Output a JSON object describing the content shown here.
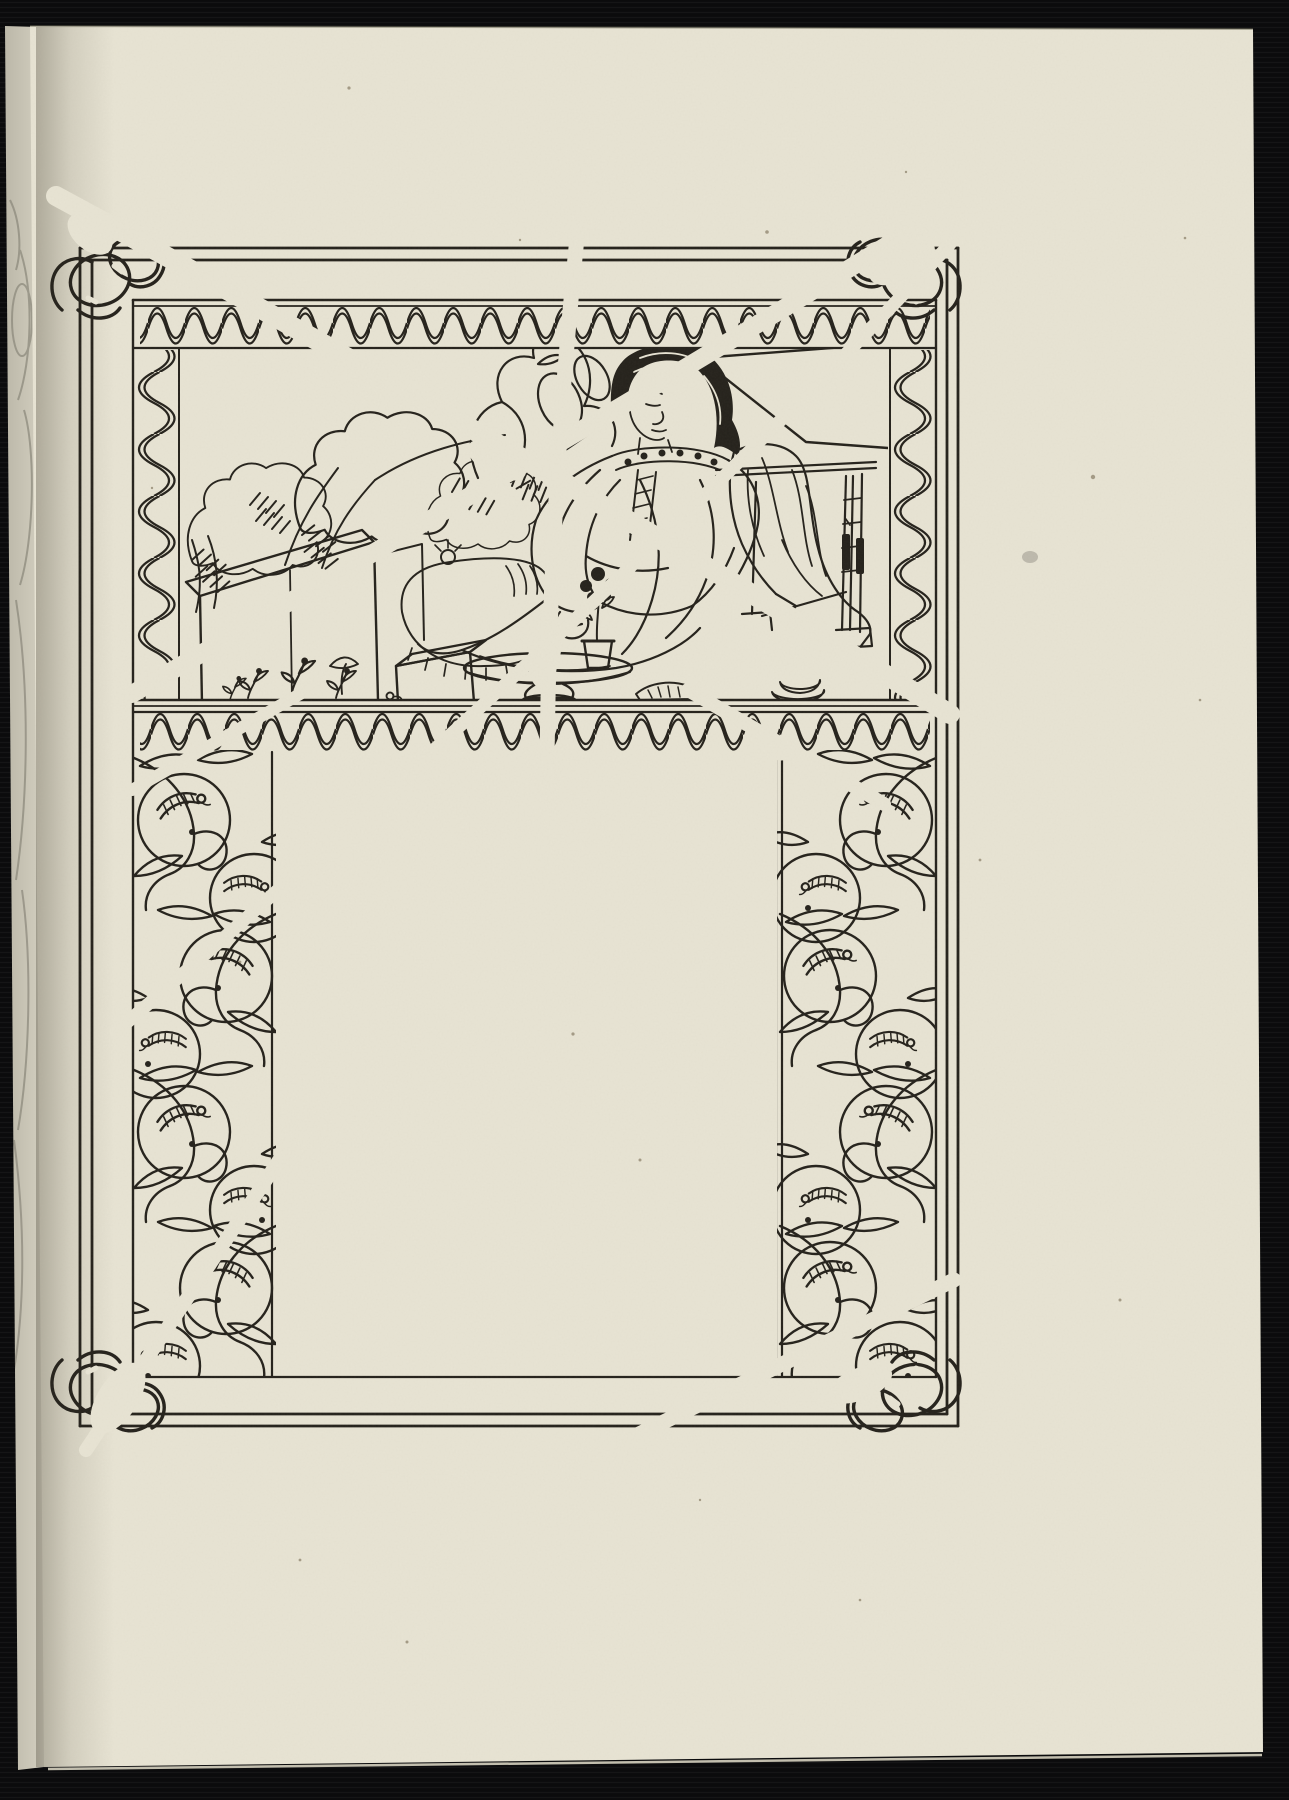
{
  "document": {
    "kind": "scanned book page",
    "description": "Scanned book page with an Art Nouveau decorative border; pictorial panel at top, blank centre, plate cancelled with white scratch lines",
    "scene_alt": "A young woman in a loose robe with an embroidered collar, seated on a bench in a garden beside a low stone wall, a draped cloth over the bench and a potted flower on a small round table",
    "border_motifs": [
      "double ruled frame",
      "wave ribbon bands",
      "apples with leaves and caterpillars",
      "interlaced ribbon corner knots"
    ],
    "center_text": ""
  },
  "colors": {
    "scan_background": "#0b0b0c",
    "paper": "#e8e4d4",
    "adjacent_page": "#d0ccbd",
    "gutter_shadow": "#5a5546",
    "ink": "#24211b",
    "scratch": "#e8e4d4"
  }
}
